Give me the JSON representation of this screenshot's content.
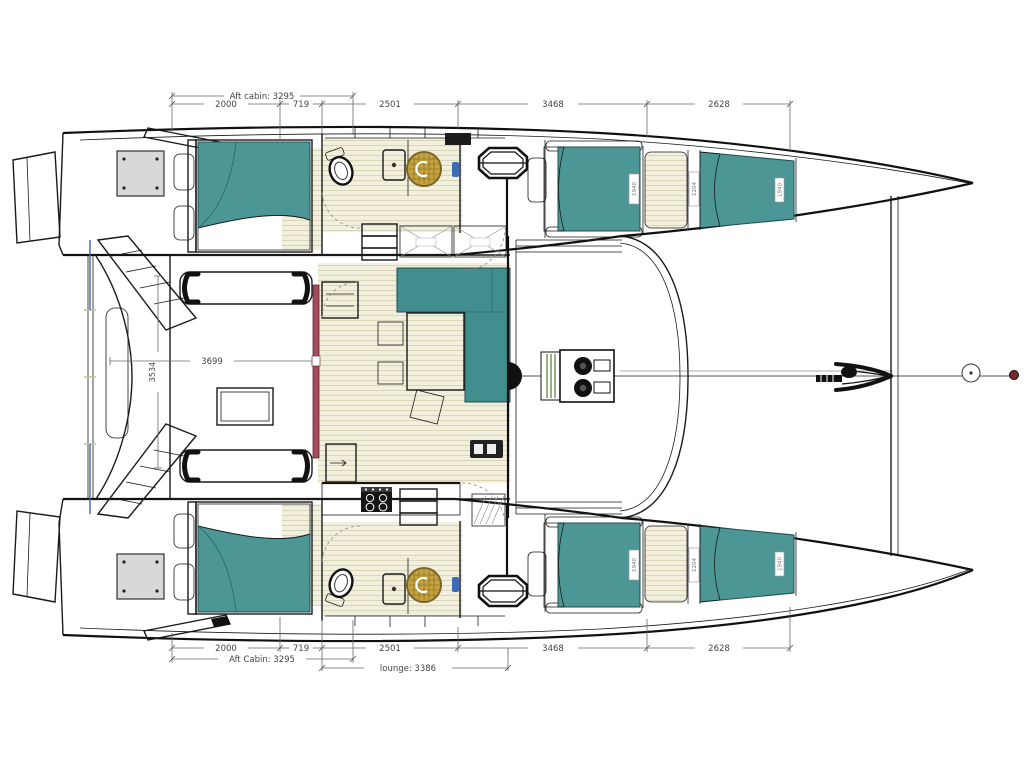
{
  "drawing": {
    "title": "Catamaran interior deck plan (top view, bow to the right)"
  },
  "dimensions": {
    "top": {
      "aft_cabin": "Aft cabin: 3295",
      "segments": [
        "2000",
        "719",
        "2501",
        "3468",
        "2628"
      ]
    },
    "bottom": {
      "segments": [
        "2000",
        "719",
        "2501",
        "3468",
        "2628"
      ],
      "aft_cabin": "Aft Cabin: 3295",
      "lounge": "lounge: 3386"
    },
    "left": {
      "beam_inner": "3534",
      "cockpit_saloon": "3699"
    }
  },
  "berth_labels": {
    "aft": "1940",
    "mid": "1204",
    "fwd": "1940"
  },
  "colors": {
    "upholstery_teal": "#4d9696",
    "sofa_teal": "#428d8d",
    "floor_beige": "#f2efdd",
    "floor_stripe": "#d9d5b9",
    "shower_gold": "#c4a23e",
    "shower_rim": "#7c6426",
    "door_red": "#a34b5c",
    "hatch_gray": "#d8d8d8",
    "accent_blue": "#3d6bb5",
    "tick_green": "#b6c98f",
    "traveller_green": "#6a8f4f"
  }
}
